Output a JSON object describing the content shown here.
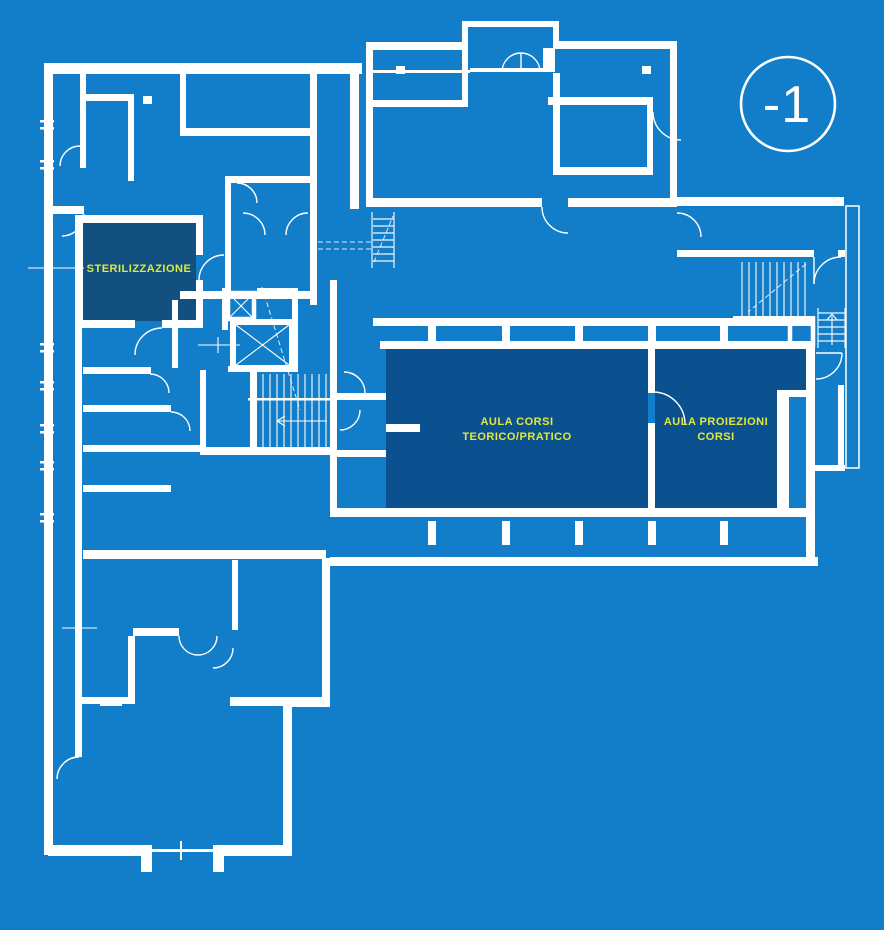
{
  "floor_plan": {
    "level_indicator": {
      "label": "-1"
    },
    "rooms": {
      "sterilizzazione": {
        "label": "STERILIZZAZIONE"
      },
      "aula_corsi": {
        "label_line1": "AULA CORSI",
        "label_line2": "TEORICO/PRATICO"
      },
      "aula_proiezioni": {
        "label_line1": "AULA PROIEZIONI",
        "label_line2": "CORSI"
      }
    },
    "colors": {
      "background": "#127DC9",
      "walls": "#FFFFFF",
      "room_fill": "#0B5190",
      "room_fill_sterilizzazione": "#11507F",
      "label_text": "#E0E93C",
      "level_text": "#FFFFFF"
    }
  }
}
